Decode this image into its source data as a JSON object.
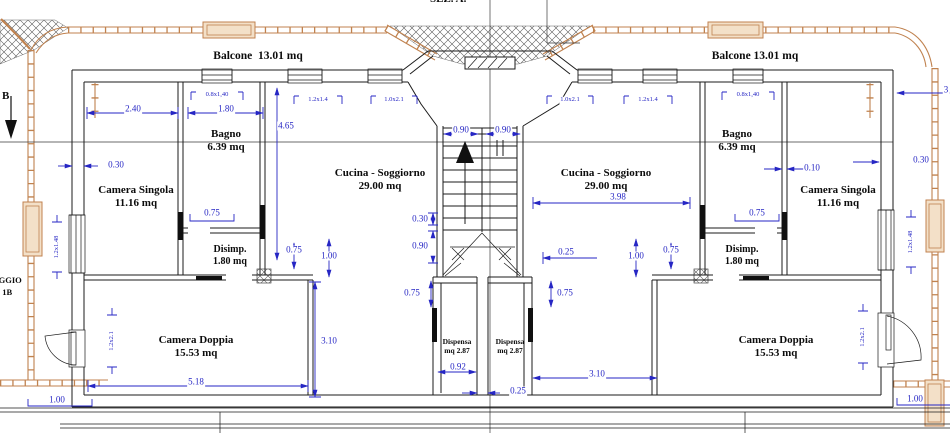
{
  "drawing": {
    "section_label_top": "SEZ. A.",
    "section_marker_left": "B",
    "clipped_text_left_line1": "OGGIO",
    "clipped_text_left_line2": ". 1B"
  },
  "colors": {
    "dimension_blue": "#2626c4",
    "line_black": "#1b1b1b",
    "railing_tan": "#c0824f",
    "planter_fill": "#f3e0c8",
    "background": "#ffffff"
  },
  "room_labels": [
    {
      "line1": "Balcone  13.01 mq",
      "line2": "",
      "x": 258,
      "y": 57,
      "fs": 11.5
    },
    {
      "line1": "Balcone 13.01 mq",
      "line2": "",
      "x": 755,
      "y": 57,
      "fs": 11.5
    },
    {
      "line1": "Bagno",
      "line2": "6.39 mq",
      "x": 226,
      "y": 141,
      "fs": 11
    },
    {
      "line1": "Bagno",
      "line2": "6.39 mq",
      "x": 737,
      "y": 141,
      "fs": 11
    },
    {
      "line1": "Camera Singola",
      "line2": "11.16 mq",
      "x": 136,
      "y": 197,
      "fs": 11
    },
    {
      "line1": "Camera Singola",
      "line2": "11.16 mq",
      "x": 838,
      "y": 197,
      "fs": 11
    },
    {
      "line1": "Cucina - Soggiorno",
      "line2": "29.00 mq",
      "x": 380,
      "y": 180,
      "fs": 11
    },
    {
      "line1": "Cucina - Soggiorno",
      "line2": "29.00 mq",
      "x": 606,
      "y": 180,
      "fs": 11
    },
    {
      "line1": "Disimp.",
      "line2": "1.80 mq",
      "x": 230,
      "y": 256,
      "fs": 10
    },
    {
      "line1": "Disimp.",
      "line2": "1.80 mq",
      "x": 742,
      "y": 256,
      "fs": 10
    },
    {
      "line1": "Camera Doppia",
      "line2": "15.53 mq",
      "x": 196,
      "y": 347,
      "fs": 11
    },
    {
      "line1": "Camera Doppia",
      "line2": "15.53 mq",
      "x": 776,
      "y": 347,
      "fs": 11
    },
    {
      "line1": "Dispensa",
      "line2": "mq 2.87",
      "x": 457,
      "y": 347,
      "fs": 7.5
    },
    {
      "line1": "Dispensa",
      "line2": "mq 2.87",
      "x": 510,
      "y": 347,
      "fs": 7.5
    }
  ],
  "dimensions": [
    {
      "t": "2.40",
      "x": 133,
      "y": 109
    },
    {
      "t": "1.80",
      "x": 226,
      "y": 109
    },
    {
      "t": "0.8x1,40",
      "x": 217,
      "y": 95,
      "s": 1
    },
    {
      "t": "4.65",
      "x": 286,
      "y": 126
    },
    {
      "t": "1.2x1.4",
      "x": 318,
      "y": 100,
      "s": 1
    },
    {
      "t": "1.0x2.1",
      "x": 394,
      "y": 100,
      "s": 1
    },
    {
      "t": "0.90",
      "x": 461,
      "y": 130
    },
    {
      "t": "0.90",
      "x": 503,
      "y": 130
    },
    {
      "t": "1.0x2.1",
      "x": 570,
      "y": 100,
      "s": 1
    },
    {
      "t": "1.2x1.4",
      "x": 648,
      "y": 100,
      "s": 1
    },
    {
      "t": "0.8x1,40",
      "x": 748,
      "y": 95,
      "s": 1
    },
    {
      "t": "0.30",
      "x": 116,
      "y": 165
    },
    {
      "t": "0.10",
      "x": 812,
      "y": 168
    },
    {
      "t": "0.30",
      "x": 921,
      "y": 160
    },
    {
      "t": "3.98",
      "x": 618,
      "y": 197
    },
    {
      "t": "0.30",
      "x": 420,
      "y": 219
    },
    {
      "t": "0.90",
      "x": 420,
      "y": 246
    },
    {
      "t": "0.25",
      "x": 566,
      "y": 252
    },
    {
      "t": "0.75",
      "x": 212,
      "y": 213
    },
    {
      "t": "0.75",
      "x": 757,
      "y": 213
    },
    {
      "t": "1.00",
      "x": 329,
      "y": 256
    },
    {
      "t": "0.75",
      "x": 294,
      "y": 250
    },
    {
      "t": "1.00",
      "x": 636,
      "y": 256
    },
    {
      "t": "0.75",
      "x": 671,
      "y": 250
    },
    {
      "t": "0.75",
      "x": 412,
      "y": 293
    },
    {
      "t": "0.75",
      "x": 565,
      "y": 293
    },
    {
      "t": "3.10",
      "x": 329,
      "y": 341
    },
    {
      "t": "3.10",
      "x": 597,
      "y": 374
    },
    {
      "t": "5.18",
      "x": 196,
      "y": 382
    },
    {
      "t": "0.92",
      "x": 458,
      "y": 367
    },
    {
      "t": "0.25",
      "x": 518,
      "y": 391
    },
    {
      "t": "1.00",
      "x": 57,
      "y": 400
    },
    {
      "t": "1.00",
      "x": 915,
      "y": 399
    },
    {
      "t": "1.2x1.48",
      "x": 57,
      "y": 247,
      "s": 1,
      "r": 1
    },
    {
      "t": "1.2x1.48",
      "x": 911,
      "y": 242,
      "s": 1,
      "r": 1
    },
    {
      "t": "1.2x2.1",
      "x": 112,
      "y": 341,
      "s": 1,
      "r": 1
    },
    {
      "t": "1.2x2.1",
      "x": 863,
      "y": 337,
      "s": 1,
      "r": 1
    },
    {
      "t": "3",
      "x": 946,
      "y": 90
    }
  ]
}
